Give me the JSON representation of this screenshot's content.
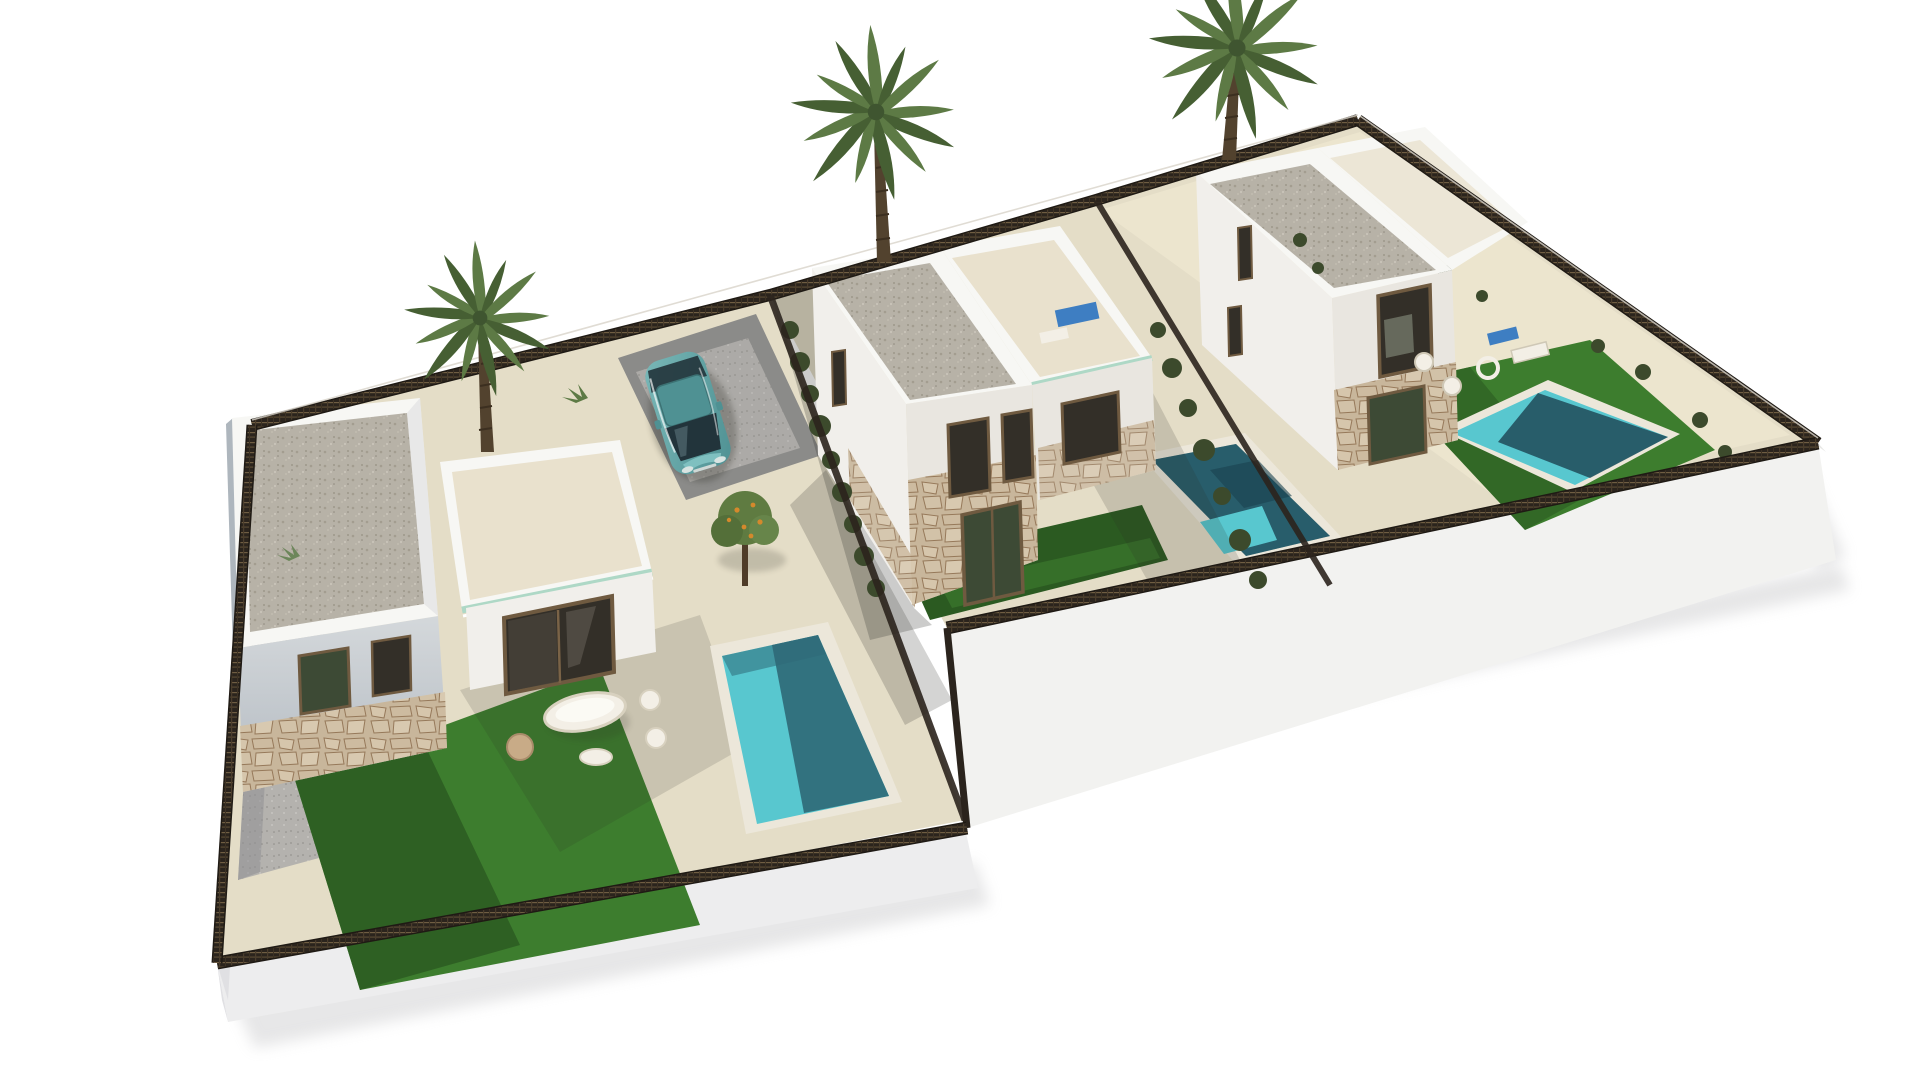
{
  "scene": {
    "description": "Aerial 3D architectural rendering of three modern two-storey white villas, each with a private pool, lawn and terrace, on a stepped plot with dark perimeter mesh fencing, three palm trees and a teal car parked in the left driveway. Pure white background.",
    "style": "photorealistic CGI exterior visualization, isometric aerial view",
    "objects": {
      "villas": 3,
      "pools": 3,
      "palm_trees": 3,
      "cars": 1,
      "sun_loungers": 3,
      "lawns": 3,
      "perimeter_fence": "dark mesh panels on white plinth",
      "roofs": "flat gravel roofs with white parapets",
      "facades": "white render with natural stone cladding on ground floor"
    }
  },
  "palette": {
    "bg": "#ffffff",
    "wall-sun": "#f1efeb",
    "wall-lit": "#e9e6e0",
    "wall-shade": "#c9ced3",
    "wall-dark": "#aeb6bd",
    "parapet": "#f7f7f4",
    "roof-gravel": "#b7b2a7",
    "terrace-floor": "#e9e1cd",
    "terrace-floor-2": "#ece6d6",
    "glass-teal": "#aed8c6",
    "patio": "#e4ddc7",
    "patio-bright": "#efe8d2",
    "stone": "#c8b69b",
    "stone-line": "#96795a",
    "lawn": "#3d7d2e",
    "lawn-shade": "#2b5a21",
    "pool-sun": "#58c7cf",
    "pool-shade": "#2f6a78",
    "pool-dark": "#214e5c",
    "coping": "#ece7da",
    "fence-dark": "#2b241d",
    "fence-tan": "#8d7856",
    "plinth-side": "#f2f2f0",
    "plinth-shade": "#e0e0e3",
    "ground-shadow": "#b9b9bc",
    "gravel-yard": "#b4b2ae",
    "driveway": "#8b8b89",
    "car-teal": "#5fa7a8",
    "car-roof": "#4f9193",
    "car-glass": "#22343b",
    "window-dark": "#332f28",
    "window-frame": "#6f5a40",
    "window-green": "#3d4a35",
    "palm-green": "#5d7a45",
    "palm-green-dark": "#465f33",
    "palm-trunk": "#52422e",
    "hedge": "#3c4a2c",
    "orange-fruit": "#d4892c",
    "furniture-white": "#f3efe6",
    "furniture-tan": "#c8ab87",
    "lounger-blue": "#3e7ec2",
    "shadow-cast": "#2a2a24"
  }
}
